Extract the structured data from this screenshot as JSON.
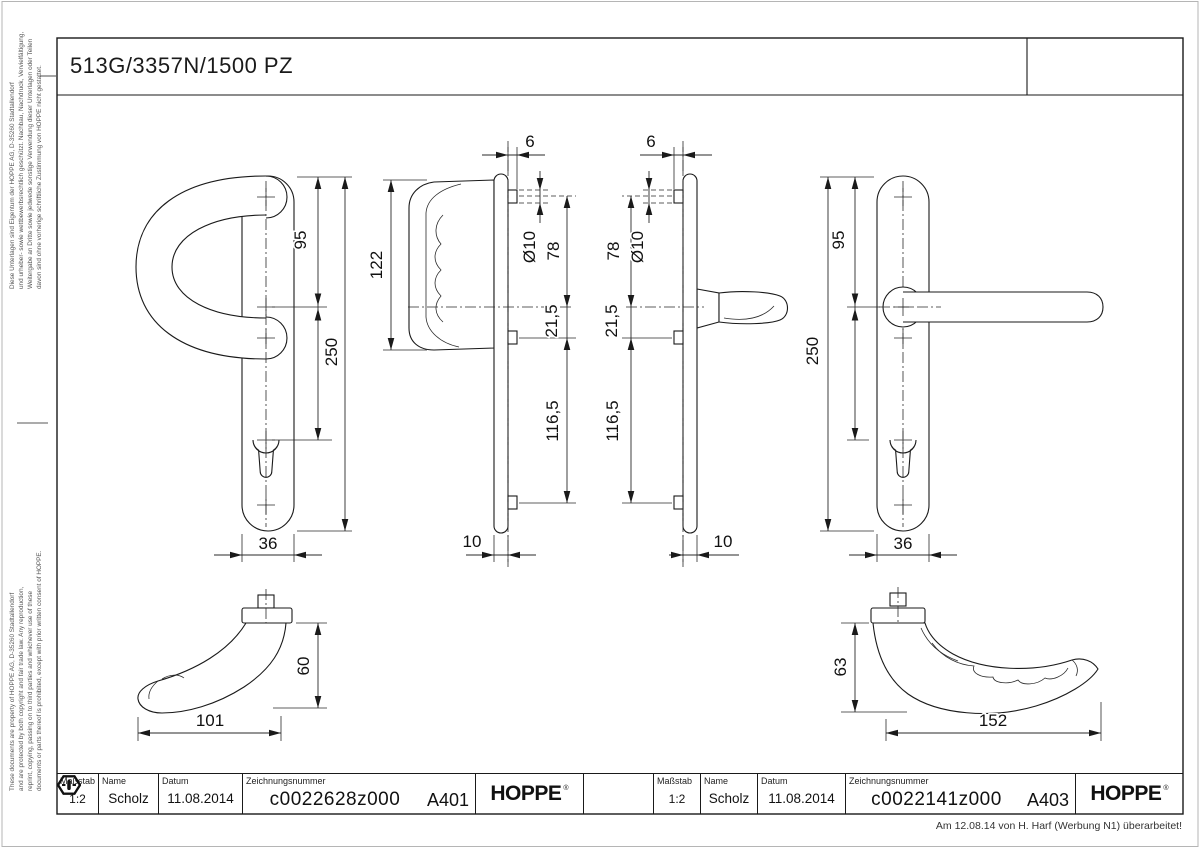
{
  "page": {
    "title": "513G/3357N/1500 PZ",
    "note": "Am 12.08.14 von H. Harf (Werbung N1) überarbeitet!"
  },
  "legal_de": [
    "Diese Unterlagen sind Eigentum der HOPPE AG, D-35260 Stadtallendorf",
    "und urheber- sowie wettbewerbsrechtlich geschützt. Nachbau, Nachdruck, Vervielfältigung,",
    "Weitergabe an Dritte sowie jedwede sonstige Verwendung dieser Unterlagen oder Teilen",
    "davon sind ohne vorherige schriftliche Zustimmung von HOPPE nicht gestattet."
  ],
  "legal_en": [
    "These documents are property of HOPPE AG, D-35260 Stadtallendorf",
    "and are protected by both copyright and fair trade law. Any reproduction,",
    "reprint, copying, passing on to third parties and whichever use of these",
    "documents or parts thereof is prohibited, except with prior written consent of HOPPE."
  ],
  "dims": {
    "v6": "6",
    "v10": "10",
    "vdia10": "Ø10",
    "v78": "78",
    "v21_5": "21,5",
    "v116_5": "116,5",
    "v122": "122",
    "v95": "95",
    "v250": "250",
    "v36": "36",
    "v60": "60",
    "v101": "101",
    "v63": "63",
    "v152": "152"
  },
  "title_blocks": {
    "left": {
      "scale_label": "Maßstab",
      "scale_value": "1:2",
      "name_label": "Name",
      "name_value": "Scholz",
      "date_label": "Datum",
      "date_value": "11.08.2014",
      "number_label": "Zeichnungsnummer",
      "number_value": "c0022628z000",
      "sheet": "A401",
      "brand": "HOPPE",
      "brand_reg": "®"
    },
    "right": {
      "scale_label": "Maßstab",
      "scale_value": "1:2",
      "name_label": "Name",
      "name_value": "Scholz",
      "date_label": "Datum",
      "date_value": "11.08.2014",
      "number_label": "Zeichnungsnummer",
      "number_value": "c0022141z000",
      "sheet": "A403",
      "brand": "HOPPE",
      "brand_reg": "®"
    }
  },
  "colors": {
    "line": "#1a1a1a",
    "background": "#ffffff"
  }
}
